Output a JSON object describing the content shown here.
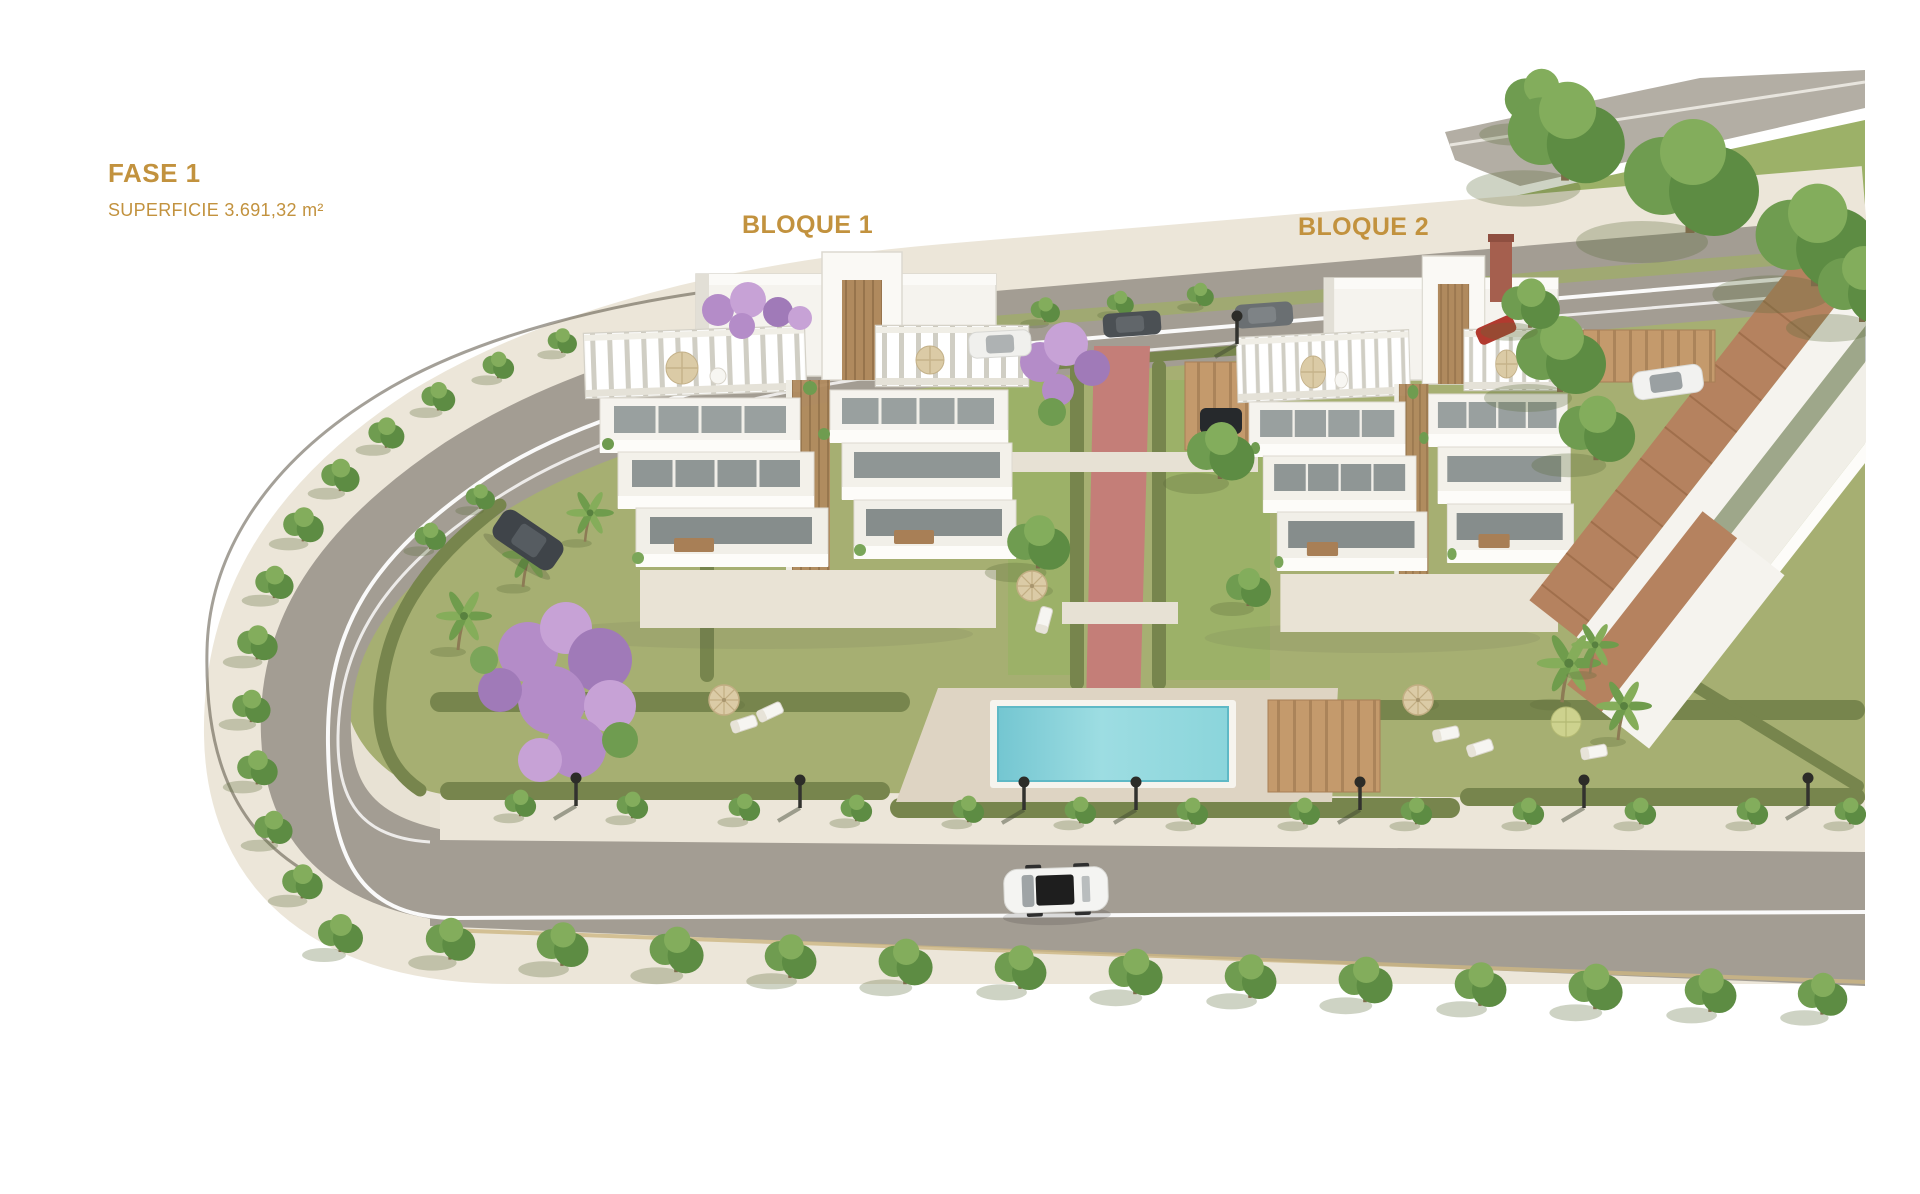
{
  "labels": {
    "phase": "FASE 1",
    "surface": "SUPERFICIE 3.691,32 m²",
    "block1": "BLOQUE 1",
    "block2": "BLOQUE 2"
  },
  "palette": {
    "label_gold": "#c2923e",
    "road_gray": "#a39d93",
    "sidewalk_cream": "#ece6d9",
    "site_cream": "#e8e2d4",
    "lawn_green": "#a6af72",
    "lawn_bright": "#9cb168",
    "hedge_green": "#77854d",
    "pool_water": "#8ed8de",
    "pool_deck": "#ded4c3",
    "path_red": "#c47e78",
    "building_white": "#f5f3ee",
    "glass_gray": "#99a09f",
    "wood_brown": "#b08a5e",
    "roof_terracotta": "#b5825f",
    "jacaranda_purple": "#b48cc8",
    "parasol_tan": "#dbcba6"
  }
}
